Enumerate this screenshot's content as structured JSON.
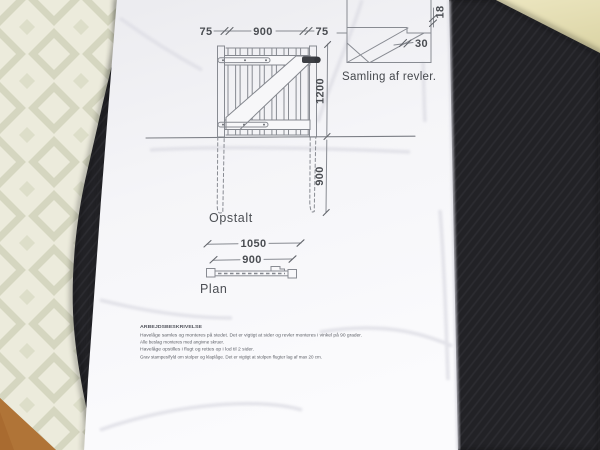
{
  "colors": {
    "paper": "#f6f6f8",
    "drawing_line": "#84878e",
    "drawing_text": "#4a4d52",
    "desk_mat": "#222226",
    "floor_tile": "#ecebdc",
    "floor_pattern": "#d5d6c0",
    "table_surface": "#e7e1b8",
    "wood_floor": "#a96b30",
    "hinge_dark": "#3c3e43"
  },
  "dims": {
    "top_left_post": "75",
    "top_gate_width": "900",
    "top_right_post": "75",
    "gate_height": "1200",
    "post_depth": "900",
    "plan_overall": "1050",
    "plan_gate": "900",
    "detail_thickness": "18",
    "detail_width": "30"
  },
  "labels": {
    "elevation_view": "Opstalt",
    "plan_view": "Plan",
    "detail_caption": "Samling af revler."
  },
  "notes": {
    "heading": "ARBEJDSBESKRIVELSE",
    "lines": [
      "Havelåge samles og monteres på stedet. Det er vigtigt at sider og revler monteres i vinkel på 90 grader.",
      "Alle beslag monteres med angivne skruer.",
      "Havelåge opstilles i flugt og rettes op i lod til 2 sider.",
      "Grav stampes/fyld om stolper og klaplåge. Det er vigtigt at stolpen flugter lag af max 20 cm."
    ]
  }
}
